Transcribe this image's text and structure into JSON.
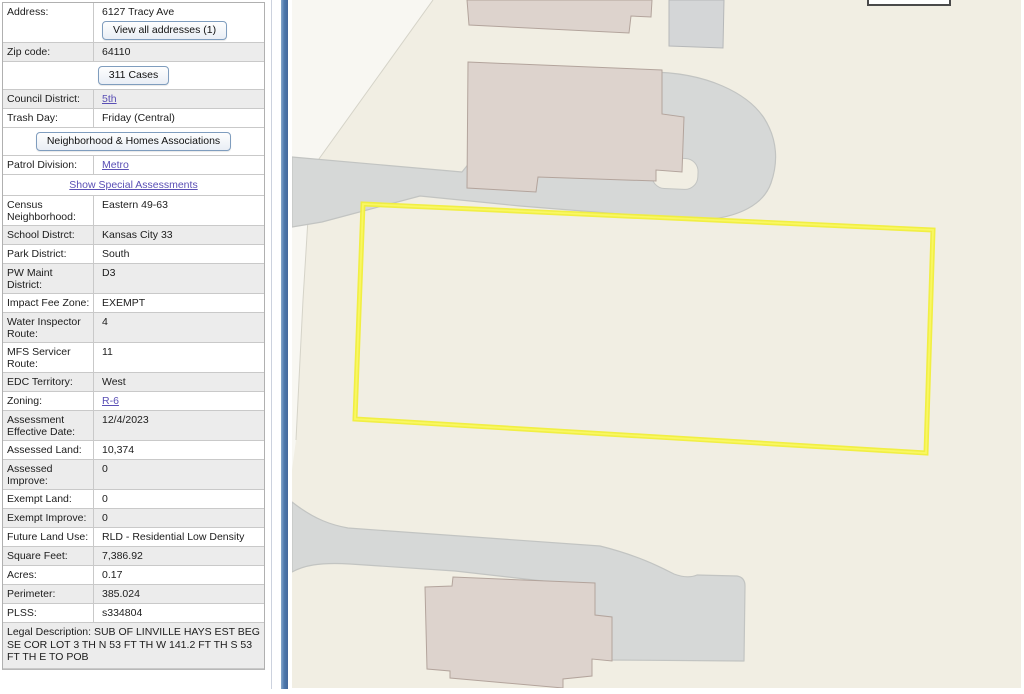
{
  "panel": {
    "rows": [
      {
        "type": "field",
        "label": "Address:",
        "value": "6127 Tracy Ave",
        "button": "View all addresses (1)",
        "shade": false
      },
      {
        "type": "field",
        "label": "Zip code:",
        "value": "64110",
        "shade": true
      },
      {
        "type": "button-row",
        "button": "311 Cases"
      },
      {
        "type": "field",
        "label": "Council District:",
        "value": "5th",
        "link": true,
        "shade": true
      },
      {
        "type": "field",
        "label": "Trash Day:",
        "value": "Friday (Central)",
        "shade": false
      },
      {
        "type": "button-row",
        "button": "Neighborhood & Homes Associations"
      },
      {
        "type": "field",
        "label": "Patrol Division:",
        "value": "Metro",
        "link": true,
        "shade": false
      },
      {
        "type": "link-row",
        "link": "Show Special Assessments"
      },
      {
        "type": "field",
        "label": "Census Neighborhood:",
        "value": "Eastern 49-63",
        "shade": false
      },
      {
        "type": "field",
        "label": "School Distrct:",
        "value": "Kansas City 33",
        "shade": true
      },
      {
        "type": "field",
        "label": "Park District:",
        "value": "South",
        "shade": false
      },
      {
        "type": "field",
        "label": "PW Maint District:",
        "value": "D3",
        "shade": true
      },
      {
        "type": "field",
        "label": "Impact Fee Zone:",
        "value": "EXEMPT",
        "shade": false
      },
      {
        "type": "field",
        "label": "Water Inspector Route:",
        "value": "4",
        "shade": true
      },
      {
        "type": "field",
        "label": "MFS Servicer Route:",
        "value": "11",
        "shade": false
      },
      {
        "type": "field",
        "label": "EDC Territory:",
        "value": "West",
        "shade": true
      },
      {
        "type": "field",
        "label": "Zoning:",
        "value": "R-6",
        "link": true,
        "shade": false
      },
      {
        "type": "field",
        "label": "Assessment Effective Date:",
        "value": "12/4/2023",
        "shade": true
      },
      {
        "type": "field",
        "label": "Assessed Land:",
        "value": "10,374",
        "shade": false
      },
      {
        "type": "field",
        "label": "Assessed Improve:",
        "value": "0",
        "shade": true
      },
      {
        "type": "field",
        "label": "Exempt Land:",
        "value": "0",
        "shade": false
      },
      {
        "type": "field",
        "label": "Exempt Improve:",
        "value": "0",
        "shade": true
      },
      {
        "type": "field",
        "label": "Future Land Use:",
        "value": "RLD - Residential Low Density",
        "shade": false
      },
      {
        "type": "field",
        "label": "Square Feet:",
        "value": "7,386.92",
        "shade": true
      },
      {
        "type": "field",
        "label": "Acres:",
        "value": "0.17",
        "shade": false
      },
      {
        "type": "field",
        "label": "Perimeter:",
        "value": "385.024",
        "shade": true
      },
      {
        "type": "field",
        "label": "PLSS:",
        "value": "s334804",
        "shade": false
      },
      {
        "type": "legal-row",
        "text": "Legal Description: SUB OF LINVILLE HAYS EST BEG SE COR LOT 3 TH N 53 FT TH W 141.2 FT TH S 53 FT TH E TO POB",
        "shade": true
      }
    ]
  },
  "map": {
    "colors": {
      "land": "#f1eee3",
      "edge_light": "#f8f7f2",
      "edge_line": "#d5d3c8",
      "road": "#d6d8d7",
      "road_border": "#c2c4c2",
      "building": "#ddd3cd",
      "building_border": "#b3a49c",
      "building_gray": "#d4d6d7",
      "building_gray_border": "#b6b8b9",
      "box_fill": "#ffffff",
      "box_border": "#4a4a4a",
      "parcel_outline": "#f0ee3a",
      "parcel_outline_inner": "#f9f767",
      "splitter_blue": "#4e79ad",
      "link_purple": "#5a4fb5",
      "row_shade": "#ececec"
    }
  }
}
